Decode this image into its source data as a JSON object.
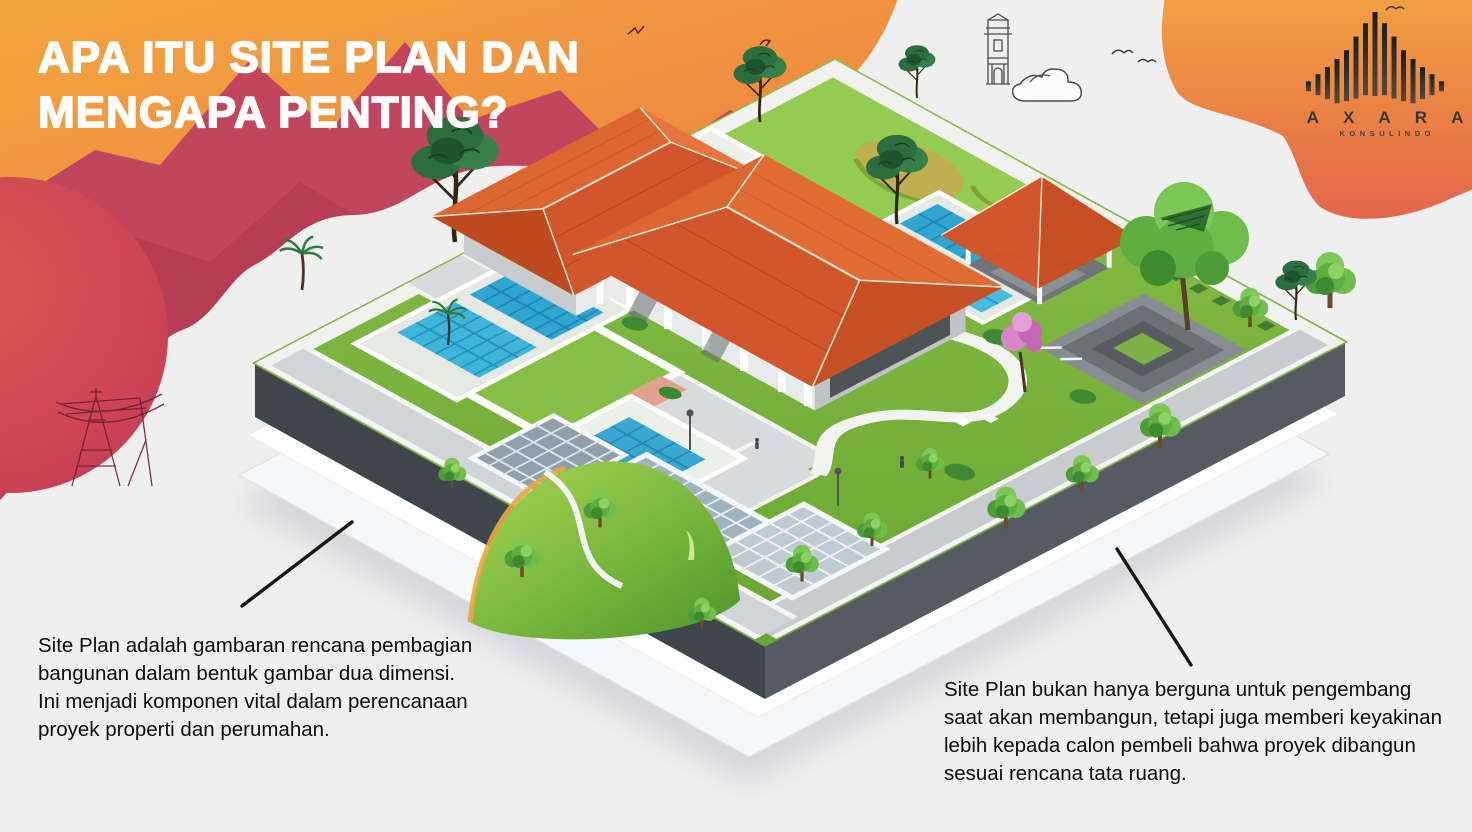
{
  "title": {
    "line1": "APA ITU SITE PLAN DAN",
    "line2": "MENGAPA PENTING?"
  },
  "logo": {
    "name": "A X A R A",
    "subtitle": "KONSULINDO",
    "mark": "bar-peak-logo-icon"
  },
  "captions": {
    "left": {
      "lines": [
        "Site Plan adalah gambaran rencana pembagian",
        "bangunan dalam bentuk gambar dua dimensi.",
        "Ini menjadi komponen vital dalam perencanaan",
        "proyek properti dan perumahan."
      ]
    },
    "right": {
      "lines": [
        "Site Plan bukan hanya berguna untuk pengembang",
        "saat akan membangun, tetapi juga memberi keyakinan",
        "lebih kepada calon pembeli bahwa proyek dibangun",
        "sesuai rencana tata ruang."
      ]
    }
  },
  "illustration": {
    "description": "Isometric 3D site plan of a property: L-shaped house with terracotta roofs, gazebo, swimming pools, lawns, trees and paths on a dark platform over stacked white sheets",
    "decorations": [
      "power-pylon-sketch",
      "water-tower-sketch",
      "cloud-sketch",
      "birds-sketch"
    ]
  },
  "palette": {
    "background": "#EFEFF0",
    "blob_orange": "#F2A13C",
    "blob_deep_orange": "#E8704A",
    "blob_crimson": "#C2455E",
    "blob_red_circle": "#D24C52",
    "roof_terracotta": "#D2562B",
    "lawn_green": "#7FBA3D",
    "pool_blue": "#35ACD6",
    "platform_gray": "#434A51",
    "text_black": "#0D0D0D",
    "title_white": "#FFFFFF"
  }
}
